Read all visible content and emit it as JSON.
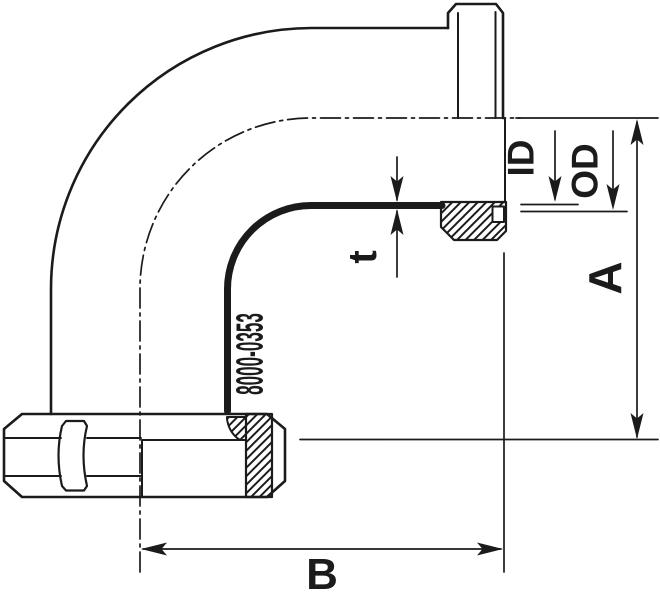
{
  "document": {
    "type": "technical-drawing",
    "description": "90 degree elbow fitting with male threaded end (half section) and union nut, dimensioned"
  },
  "part_number": "8000-0353",
  "labels": {
    "inner_diameter": "ID",
    "outer_diameter": "OD",
    "wall_thickness": "t",
    "center_to_face_vertical": "A",
    "center_to_face_horizontal": "B"
  },
  "colors": {
    "line": "#1b1b1b",
    "background": "#ffffff"
  }
}
